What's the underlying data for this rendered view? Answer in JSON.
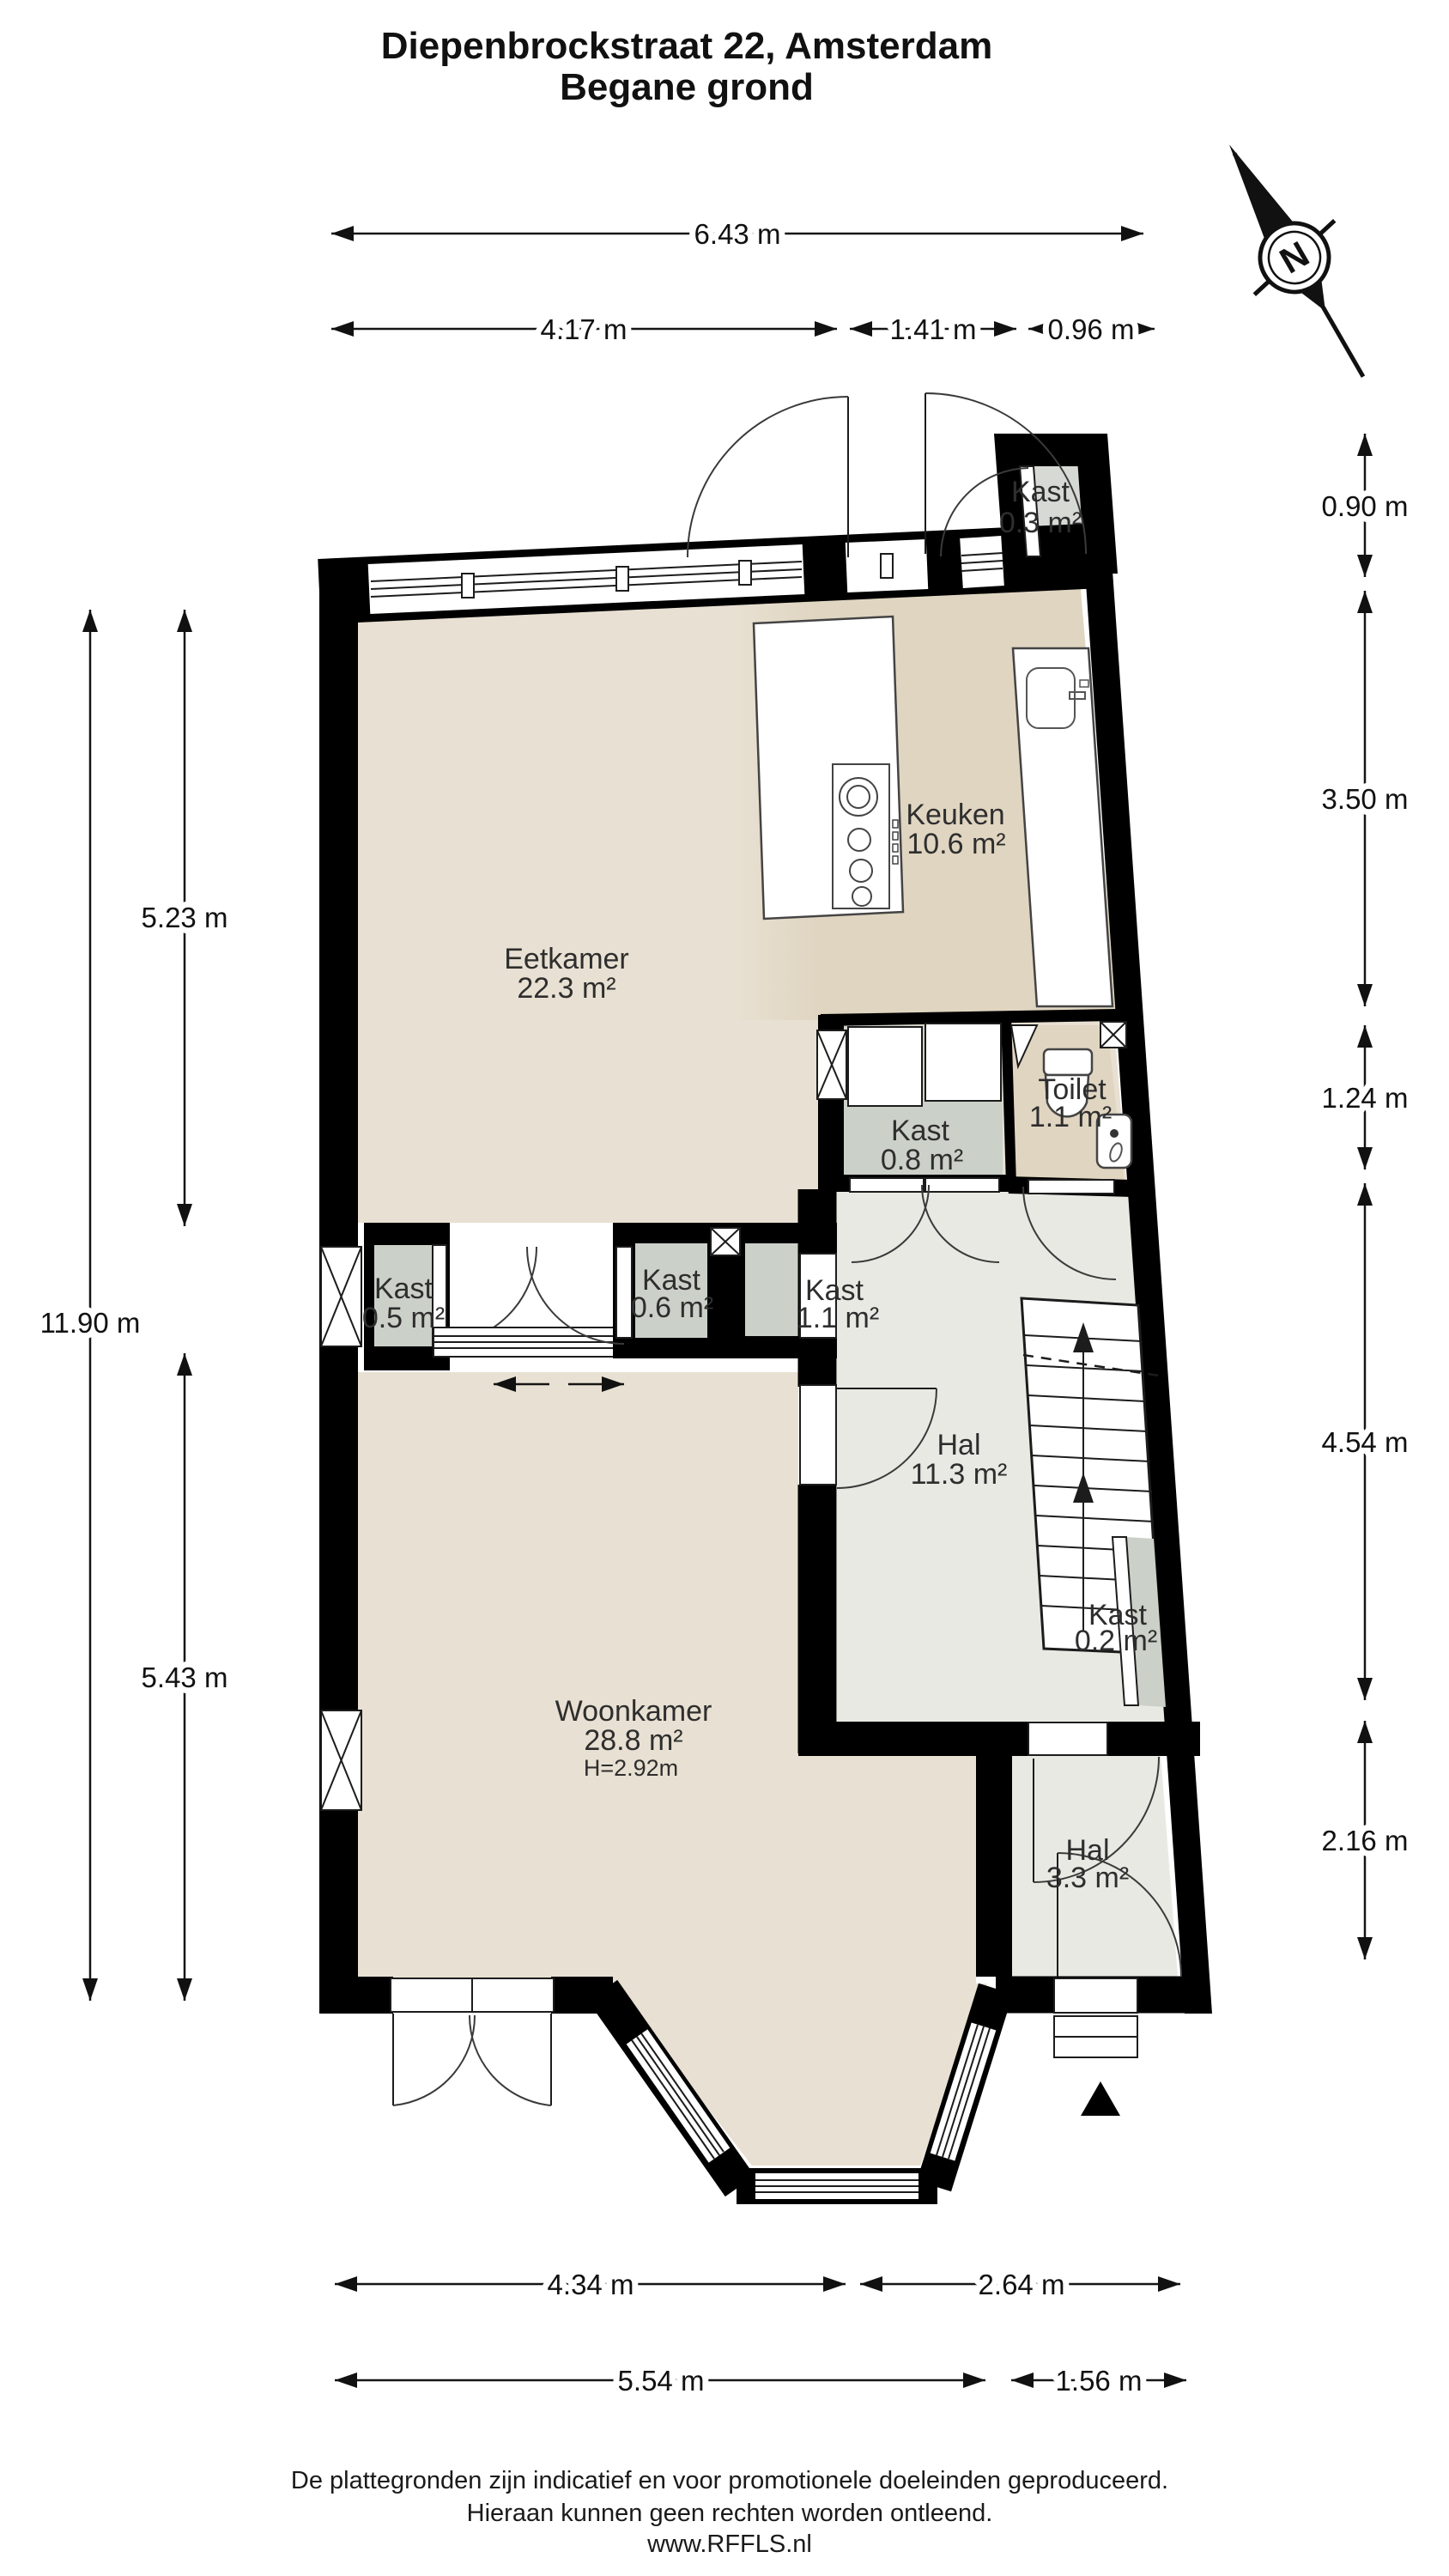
{
  "title": {
    "line1": "Diepenbrockstraat 22, Amsterdam",
    "line2": "Begane grond"
  },
  "compass": {
    "label": "N"
  },
  "rooms": {
    "kast03": {
      "name": "Kast",
      "area": "0.3 m²"
    },
    "keuken": {
      "name": "Keuken",
      "area": "10.6 m²"
    },
    "eetkamer": {
      "name": "Eetkamer",
      "area": "22.3 m²"
    },
    "toilet": {
      "name": "Toilet",
      "area": "1.1 m²"
    },
    "kast08": {
      "name": "Kast",
      "area": "0.8 m²"
    },
    "kast05": {
      "name": "Kast",
      "area": "0.5 m²"
    },
    "kast06": {
      "name": "Kast",
      "area": "0.6 m²"
    },
    "kast11": {
      "name": "Kast",
      "area": "1.1 m²"
    },
    "hal": {
      "name": "Hal",
      "area": "11.3 m²"
    },
    "kast02": {
      "name": "Kast",
      "area": "0.2 m²"
    },
    "woonkamer": {
      "name": "Woonkamer",
      "area": "28.8 m²",
      "height": "H=2.92m"
    },
    "halEntree": {
      "name": "Hal",
      "area": "3.3 m²"
    }
  },
  "dimensions": {
    "top": [
      "6.43 m",
      "4.17 m",
      "1.41 m",
      "0.96 m"
    ],
    "right": [
      "0.90 m",
      "3.50 m",
      "1.24 m",
      "4.54 m",
      "2.16 m"
    ],
    "left": [
      "5.23 m",
      "11.90 m",
      "5.43 m"
    ],
    "bottom": [
      "4.34 m",
      "2.64 m",
      "5.54 m",
      "1.56 m"
    ]
  },
  "footer": {
    "line1": "De plattegronden zijn indicatief en voor promotionele doeleinden geproduceerd.",
    "line2": "Hieraan kunnen geen rechten worden ontleend.",
    "line3": "www.RFFLS.nl"
  },
  "colors": {
    "room_beige": "#e8e0d2",
    "room_tan": "#e0d5c1",
    "room_gray": "#e9e9e4",
    "kast_gray": "#cbd0c8",
    "kast03_gray": "#d7d9d5",
    "wall_black": "#000000"
  }
}
